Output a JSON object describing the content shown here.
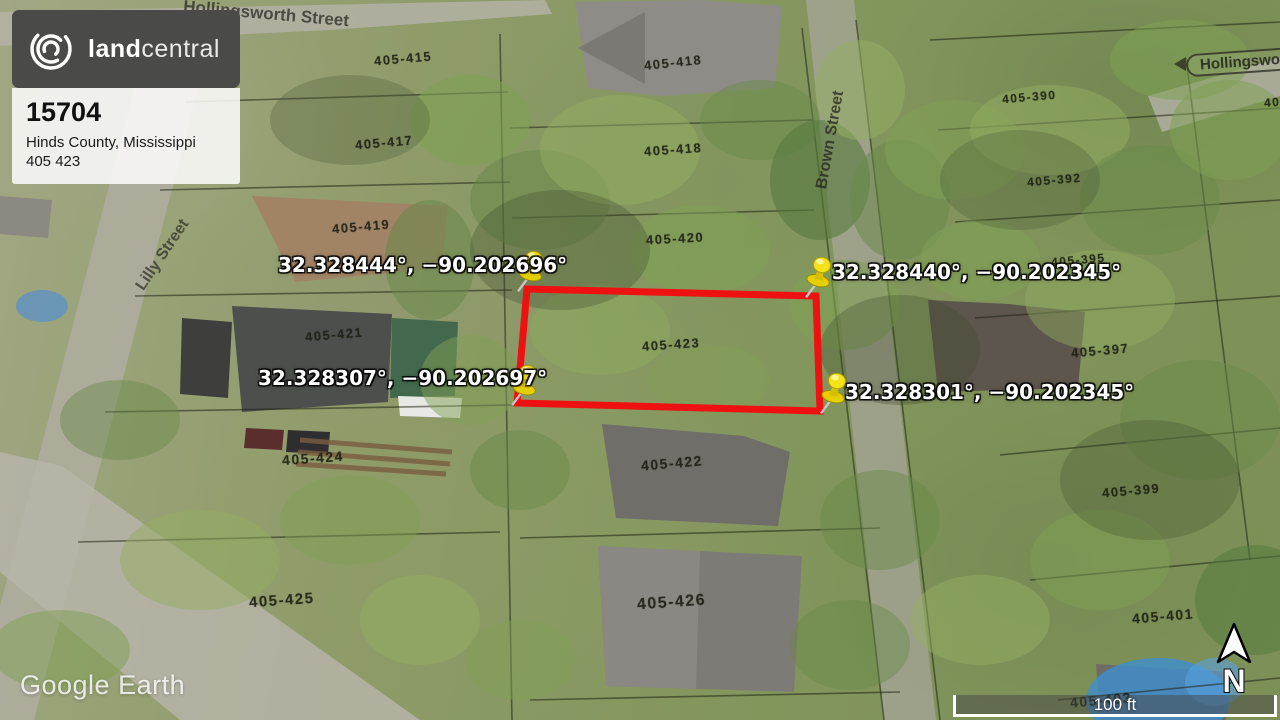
{
  "brand": {
    "name_bold": "land",
    "name_light": "central",
    "listing_id": "15704",
    "location": "Hinds County, Mississippi",
    "parcel_number": "405 423"
  },
  "pins": [
    {
      "position": "top-left",
      "label": "32.328444°, −90.202696°"
    },
    {
      "position": "top-right",
      "label": "32.328440°, −90.202345°"
    },
    {
      "position": "bottom-left",
      "label": "32.328307°, −90.202697°"
    },
    {
      "position": "bottom-right",
      "label": "32.328301°, −90.202345°"
    }
  ],
  "streets": {
    "top": "Hollingsworth Street",
    "right_sign": "Hollingsworth",
    "left": "Lilly Street",
    "middle": "Brown Street"
  },
  "parcel_labels": [
    {
      "text": "405-415"
    },
    {
      "text": "405-417"
    },
    {
      "text": "405-418"
    },
    {
      "text": "405-418"
    },
    {
      "text": "405-419"
    },
    {
      "text": "405-420"
    },
    {
      "text": "405-421"
    },
    {
      "text": "405-423"
    },
    {
      "text": "405-422"
    },
    {
      "text": "405-424"
    },
    {
      "text": "405-425"
    },
    {
      "text": "405-426"
    },
    {
      "text": "405-390"
    },
    {
      "text": "405-392"
    },
    {
      "text": "405-395"
    },
    {
      "text": "405-397"
    },
    {
      "text": "405-399"
    },
    {
      "text": "405-401"
    },
    {
      "text": "405-403"
    },
    {
      "text": "405"
    }
  ],
  "watermark": "Google Earth",
  "scale_bar": {
    "label": "100 ft"
  },
  "compass": {
    "label": "N"
  },
  "colors": {
    "boundary_red": "#ee1111",
    "pin_yellow": "#f2df1d",
    "brand_bg": "#4a4a49"
  }
}
